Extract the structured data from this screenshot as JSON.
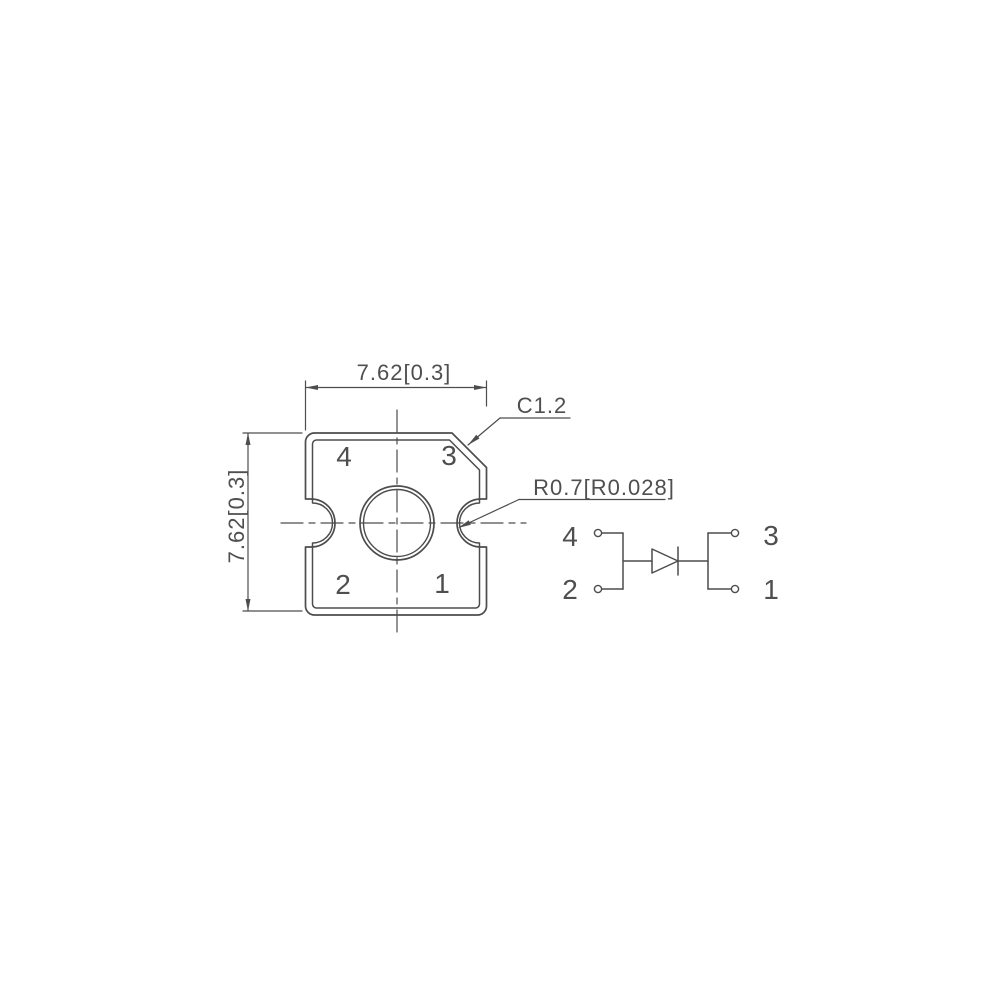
{
  "colors": {
    "line": "#4d4d4d",
    "text": "#4f4f4f",
    "background": "#ffffff"
  },
  "top_view": {
    "width_dimension": "7.62[0.3]",
    "height_dimension": "7.62[0.3]",
    "chamfer_callout": "C1.2",
    "radius_callout": "R0.7[R0.028]",
    "pad_labels": {
      "top_left": "4",
      "top_right": "3",
      "bottom_left": "2",
      "bottom_right": "1"
    }
  },
  "schematic": {
    "pin_labels": {
      "top_left": "4",
      "bottom_left": "2",
      "top_right": "3",
      "bottom_right": "1"
    }
  }
}
